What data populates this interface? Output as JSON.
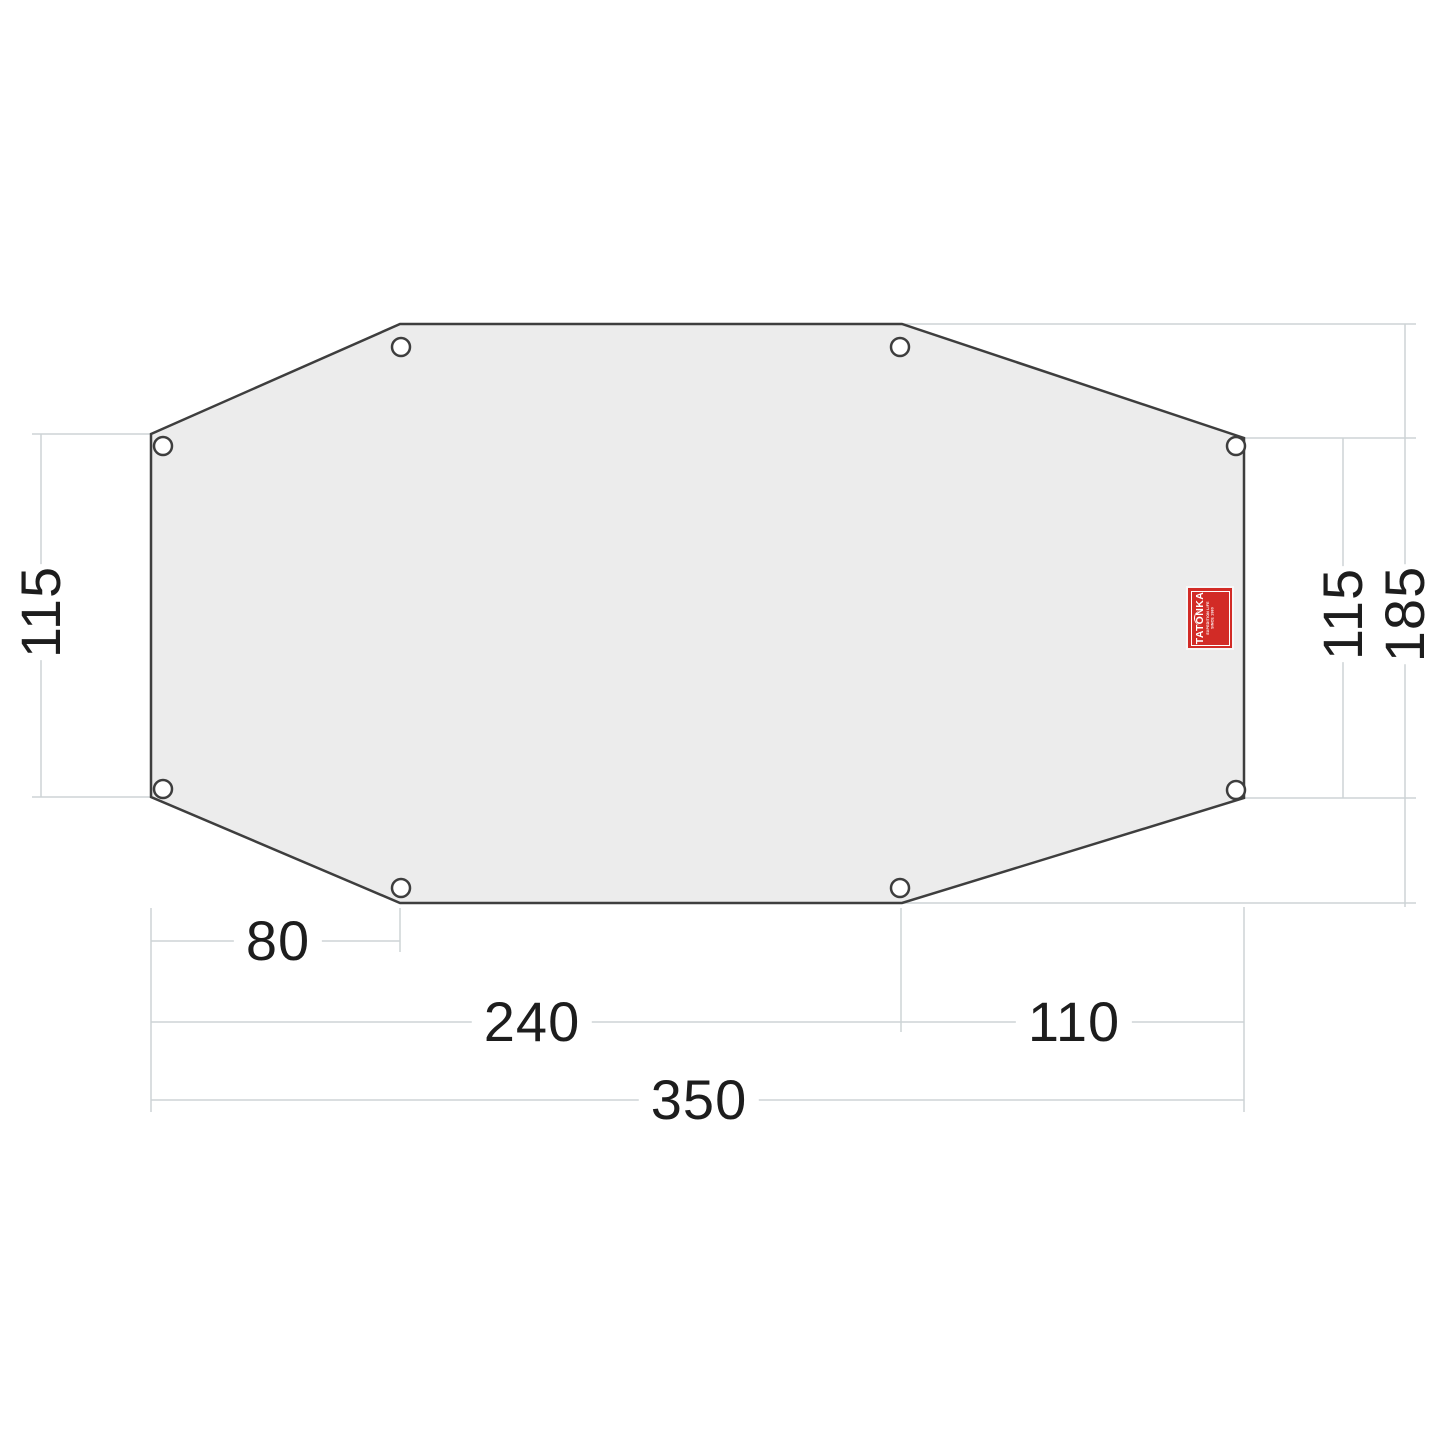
{
  "diagram": {
    "kind": "tent-footprint-dimension-drawing",
    "units": "cm",
    "dimensions": {
      "left_height": "115",
      "right_height": "115",
      "total_height": "185",
      "bottom_left_offset": "80",
      "bottom_left_to_right_corner": "240",
      "bottom_right_segment": "110",
      "total_width": "350"
    },
    "shape": {
      "type": "elongated-octagon",
      "grommet_count": 8,
      "fill_color": "#ececec",
      "outline_color": "#3e3e3e"
    },
    "lines": {
      "dimension_line_color": "#cdd4d6",
      "text_color": "#1d1d1d"
    },
    "brand": {
      "name": "TATONKA",
      "tagline_line1": "EXPEDITION LIFE",
      "tagline_line2": "SINCE 1980",
      "label_color": "#d22b26",
      "label_text_color": "#ffffff"
    }
  }
}
